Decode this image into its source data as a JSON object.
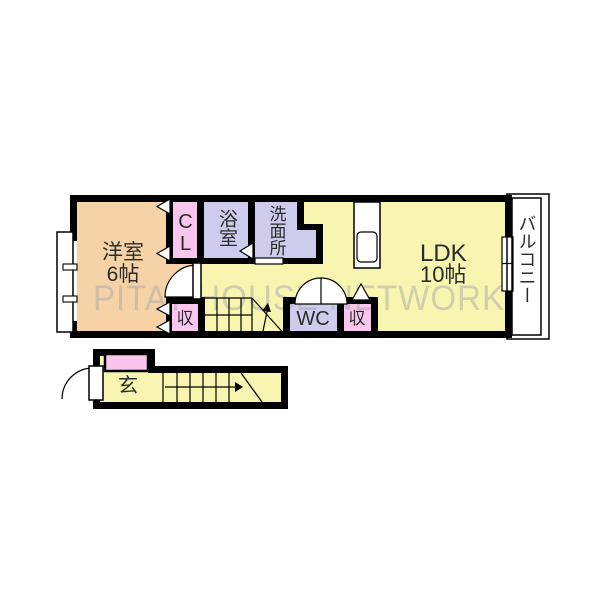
{
  "floorplan": {
    "watermark": "PITAT HOUSE NETWORK",
    "rooms": {
      "western": {
        "line1": "洋室",
        "line2": "6帖"
      },
      "closet": {
        "label": "CL"
      },
      "bath": {
        "label": "浴室"
      },
      "washroom": {
        "label": "洗面所"
      },
      "ldk": {
        "line1": "LDK",
        "line2": "10帖"
      },
      "balcony": {
        "label": "バルコニー"
      },
      "wc": {
        "label": "WC"
      },
      "storage_left": {
        "label": "収"
      },
      "storage_right": {
        "label": "収"
      },
      "entrance": {
        "label": "玄"
      }
    },
    "colors": {
      "western_room": "#f6d3a7",
      "closet_pink": "#f9c6ee",
      "bath_lavender": "#cdccec",
      "ldk_yellow": "#f8f5b0",
      "wall_black": "#000000",
      "watermark_gray": "#a9a9a9",
      "background": "#ffffff"
    }
  }
}
